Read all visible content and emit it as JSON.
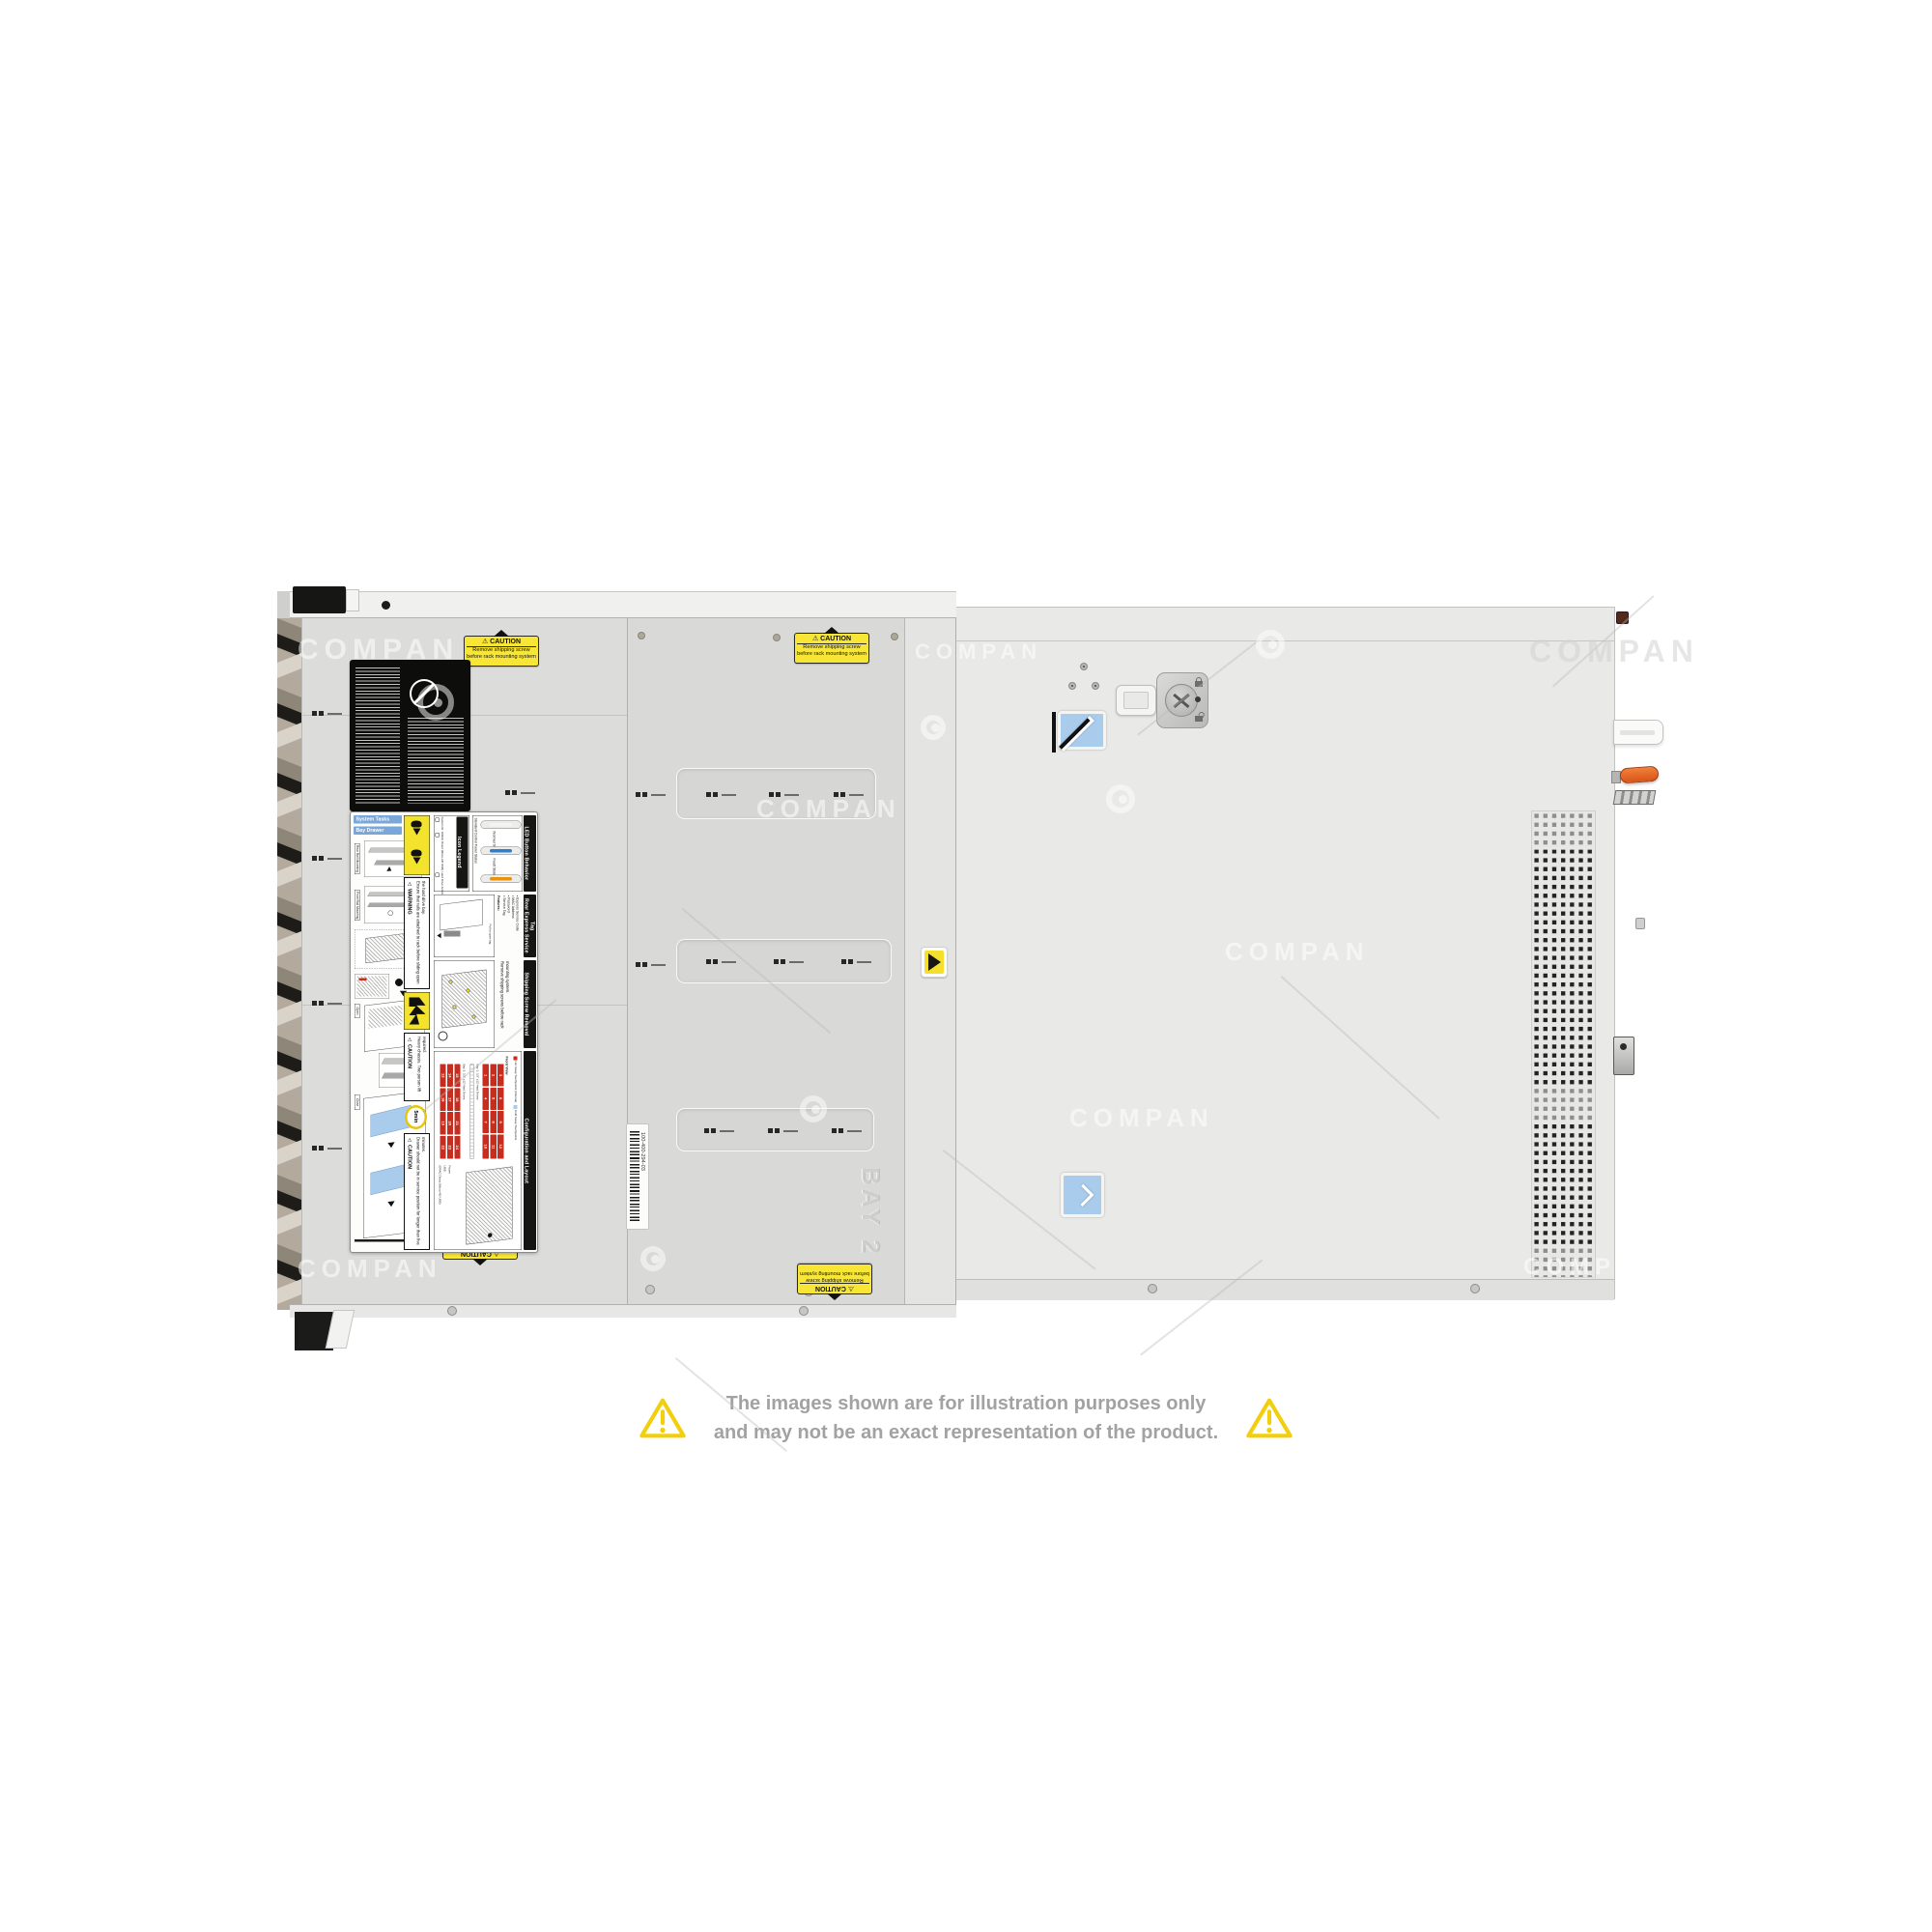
{
  "watermark": {
    "text": "COMPAN"
  },
  "disclaimer": {
    "line1": "The images shown are for illustration purposes only",
    "line2": "and may not be an exact representation of the product.",
    "text_color": "#a2a2a2",
    "triangle_color": "#f2cf0e"
  },
  "caution_sticker": {
    "title": "⚠ CAUTION",
    "line1": "Remove shipping screw",
    "line2": "before rack mounting system"
  },
  "barcode_label": {
    "text": "100-400-294-03"
  },
  "embossed_bay2": "BAY 2",
  "colors": {
    "caution_yellow": "#f8e636",
    "touchpoint_blue": "#a9cbec",
    "handle_orange": "#e2571b",
    "label_header_blue": "#7aa7d9",
    "drive_cell_red": "#c62d1f"
  },
  "service_label": {
    "hdr_system_tasks": "System Tasks",
    "hdr_bay_drawer": "Bay Drawer Operation",
    "tag_rear_rail": "Rear Rail Mounting",
    "tag_front_rail": "Front Rail Mounting",
    "tag_open": "Open",
    "tag_close": "Close",
    "warning_title": "⚠ WARNING",
    "warning_text": "Ensure that rails are attached to rack before sliding open the hard drive bay.",
    "caution_heavy_title": "⚠ CAUTION",
    "caution_heavy_text": "Heavy chassis. Two person lift required.",
    "five_min": "5min",
    "caution_drawer_title": "⚠ CAUTION",
    "caution_drawer_text": "Drawer should not be in service position for longer than five minutes.",
    "icon_legend": {
      "title": "Icon Legend",
      "items": [
        "System ID",
        "iDRAC Direct (Micro-AB USB)",
        "Hard Drive Activity",
        "USB 2.0"
      ]
    },
    "led": {
      "title": "LED Button Behavior",
      "subtitle": "Standard Control Panel Status",
      "states": [
        {
          "label": "",
          "color": "#f4f4f2"
        },
        {
          "label": "Normal State",
          "color": "#2f7fd0"
        },
        {
          "label": "Fault State",
          "color": "#e8930f"
        }
      ]
    },
    "rear_tag": {
      "title": "Rear Express Service Tag",
      "features_title": "Features:",
      "items": [
        "Service Tag",
        "Password",
        "MAC Address",
        "Express Service Code"
      ],
      "pull": "Pull to open tag"
    },
    "shipping": {
      "title": "Shipping Screw Removal",
      "text": "Remove shipping screws before rack mounting system."
    },
    "config": {
      "title": "Configuration and Layout",
      "front_view": "Front View",
      "legend_hot": "Hot Swap Touchpoints (Internal)",
      "legend_cold": "Cold Swap Touchpoints",
      "bay1_caption": "Bay 1: 3.5\" x12 Hard Drives",
      "bay2_caption": "Bay 2: 3.5\" x12 Hard Drives",
      "bay1": [
        "1",
        "2",
        "3",
        "4",
        "5",
        "6",
        "7",
        "8",
        "9",
        "10",
        "11",
        "12"
      ],
      "bay2": [
        "13",
        "14",
        "15",
        "16",
        "17",
        "18",
        "19",
        "20",
        "21",
        "22",
        "23",
        "24"
      ],
      "ports": [
        "iDRAC Direct (Micro-AB USB)",
        "USB",
        "Power"
      ],
      "cell_bg": "#c62d1f"
    }
  }
}
